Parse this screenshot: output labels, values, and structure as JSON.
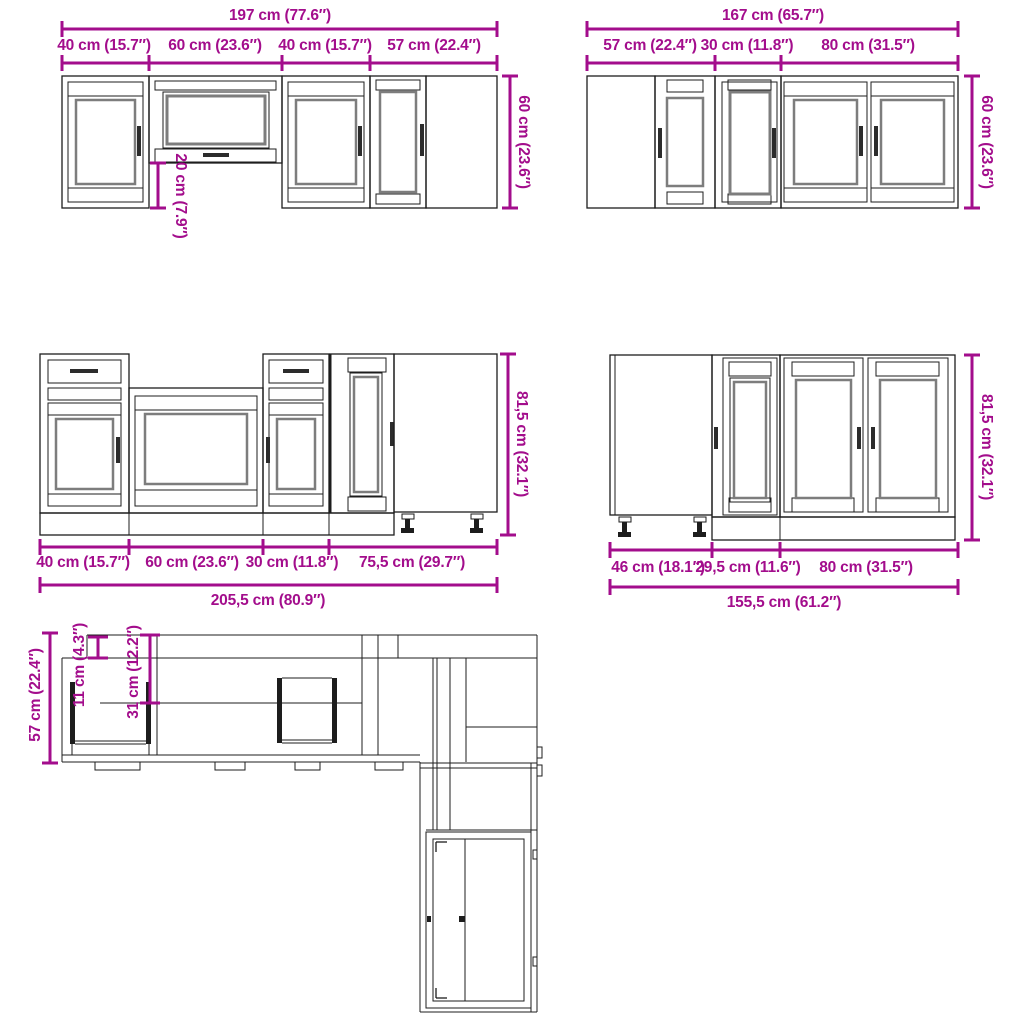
{
  "diagram": {
    "title": "kitchen-cabinet-set-dimension-diagram",
    "colors": {
      "dimension_accent": "#A30D8C",
      "drawing_line": "#1D1D1D",
      "glass_panel_line": "#7D7D7D",
      "background": "#FFFFFF"
    },
    "wall_run_left": {
      "total": "197 cm (77.6″)",
      "segments": [
        "40 cm (15.7″)",
        "60 cm (23.6″)",
        "40 cm (15.7″)",
        "57 cm (22.4″)"
      ],
      "height": "60 cm (23.6″)",
      "glass_cabinet_drop": "20 cm (7.9″)"
    },
    "wall_run_right": {
      "total": "167 cm (65.7″)",
      "segments": [
        "57 cm (22.4″)",
        "30 cm (11.8″)",
        "80 cm (31.5″)"
      ],
      "height": "60 cm (23.6″)"
    },
    "base_run_left": {
      "total": "205,5 cm (80.9″)",
      "segments": [
        "40 cm (15.7″)",
        "60 cm (23.6″)",
        "30 cm (11.8″)",
        "75,5 cm (29.7″)"
      ],
      "height": "81,5 cm (32.1″)"
    },
    "base_run_right": {
      "total": "155,5 cm (61.2″)",
      "segments": [
        "46 cm (18.1″)",
        "29,5 cm (11.6″)",
        "80 cm (31.5″)"
      ],
      "height": "81,5 cm (32.1″)"
    },
    "plan_view": {
      "depth_total": "57 cm (22.4″)",
      "depth_cornice": "11 cm (4.3″)",
      "depth_wall_cabinet": "31 cm (12.2″)"
    }
  }
}
